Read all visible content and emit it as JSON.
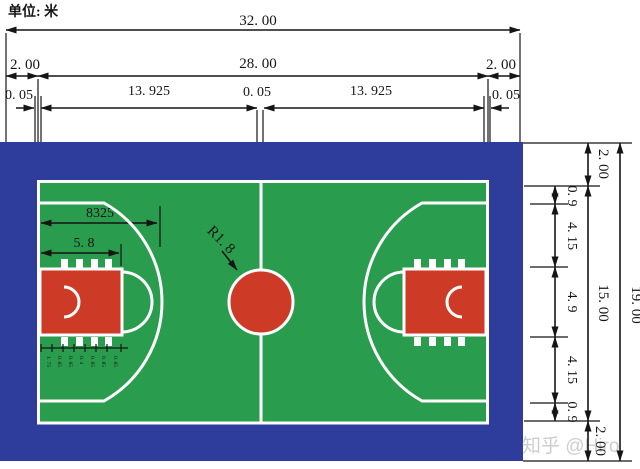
{
  "unit_label": "单位:  米",
  "watermark": "知乎 @Hiro",
  "colors": {
    "apron_blue": "#2e3d9c",
    "court_green": "#2a9c4e",
    "key_red": "#cd3a26",
    "court_line_white": "#ffffff",
    "dimension_black": "#151515"
  },
  "top_dims": {
    "total": "32. 00",
    "left_margin": "2. 00",
    "inner_width": "28. 00",
    "right_margin": "2. 00",
    "lw_left": "0. 05",
    "half_left": "13. 925",
    "lw_center": "0. 05",
    "half_right": "13. 925",
    "lw_right": "0. 05"
  },
  "right_dims": {
    "total": "19. 00",
    "inner_height": "15. 00",
    "top_margin": "2. 00",
    "bottom_margin": "2. 00",
    "segments": [
      "0. 9",
      "4. 15",
      "4. 9",
      "4. 15",
      "0. 9"
    ]
  },
  "court_dims": {
    "three_point_depth": "8325",
    "free_throw_dist": "5. 8",
    "center_circle_radius": "R1. 8",
    "lane_marks": [
      "1. 75",
      "0. 85",
      "0. 85",
      "0. 4",
      "0. 85",
      "0. 85",
      "0. 85"
    ]
  }
}
